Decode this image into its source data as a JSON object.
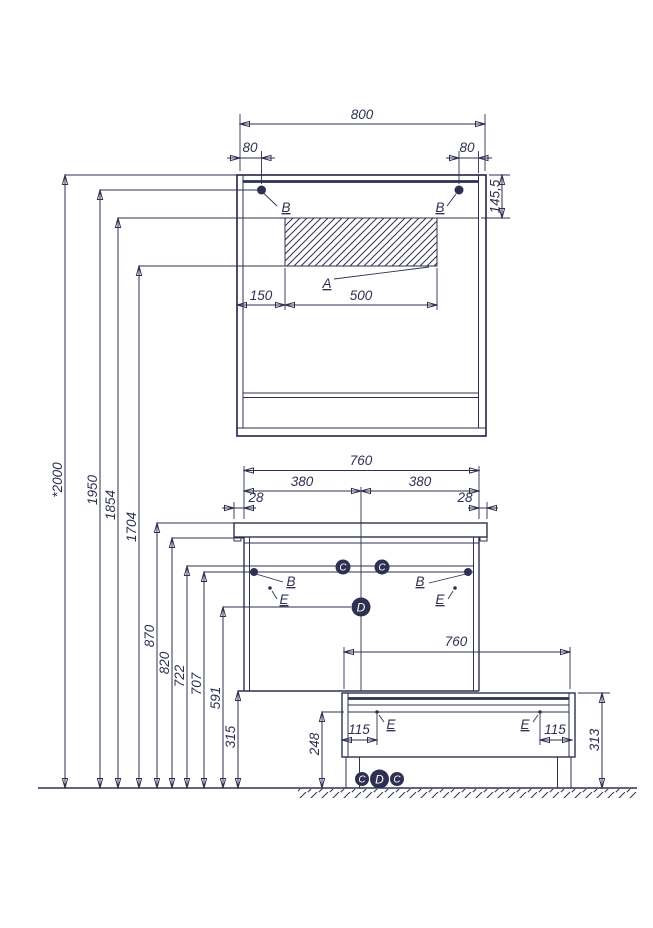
{
  "page": {
    "description": "Bathroom furniture installation dimensions drawing: mirror cabinet, washbasin vanity and base unit",
    "background": "#ffffff"
  },
  "colors": {
    "ink": "#2e3052"
  },
  "labels": {
    "a": "A",
    "b": "B",
    "c": "C",
    "d": "D",
    "e": "E"
  },
  "mirror": {
    "width": "800",
    "offset_left": "80",
    "offset_right": "80",
    "top_section_height": "145,5",
    "panel_offset": "150",
    "panel_width": "500"
  },
  "vanity": {
    "width": "760",
    "half_left": "380",
    "half_right": "380",
    "overhang_left": "28",
    "overhang_right": "28"
  },
  "base": {
    "width": "760",
    "inset_left": "115",
    "inset_right": "115",
    "height": "313"
  },
  "heights": [
    "*2000",
    "1950",
    "1854",
    "1704",
    "870",
    "820",
    "722",
    "707",
    "591",
    "315",
    "248"
  ]
}
